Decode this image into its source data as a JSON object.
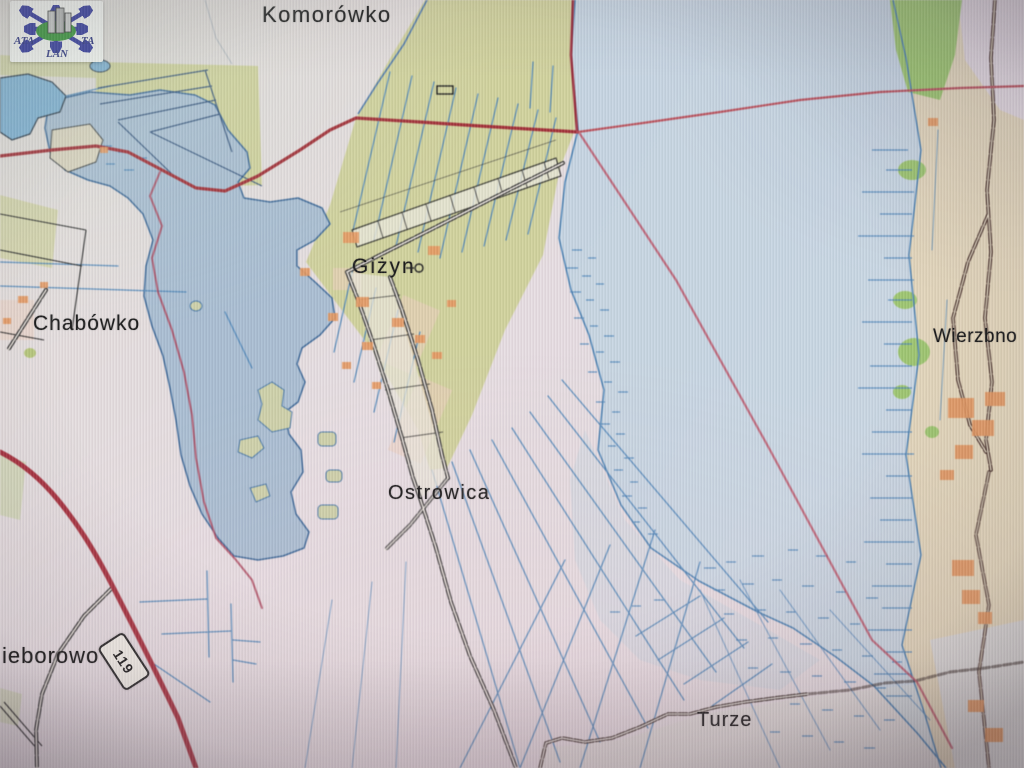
{
  "logo": {
    "text_left": "ATA",
    "text_right": "TA",
    "text_bottom": "LAN"
  },
  "map": {
    "labels": [
      {
        "id": "komorowko",
        "text": "Komorówko"
      },
      {
        "id": "chabowko",
        "text": "Chabówko"
      },
      {
        "id": "gizyn",
        "text": "Giżyn"
      },
      {
        "id": "ostrowica",
        "text": "Ostrowica"
      },
      {
        "id": "wierzbno",
        "text": "Wierzbno"
      },
      {
        "id": "turze",
        "text": "Turze"
      },
      {
        "id": "nieborowo_partial",
        "text": "ieborowo"
      }
    ],
    "road_shield": {
      "number": "119"
    },
    "colors": {
      "land": "#e7dfe2",
      "farmland": "#d2d39c",
      "water_large": "#c9d9e5",
      "water_small": "#aabfd4",
      "pond": "#7fb3d8",
      "road_major": "#a83038",
      "road_dark": "#402620",
      "boundary_pink": "#c05568",
      "drainage_blue": "#4c86bc",
      "buildings_orange": "#e89a60",
      "vegetation_green": "#9fc96f",
      "label_text": "#1b1b1b"
    }
  }
}
